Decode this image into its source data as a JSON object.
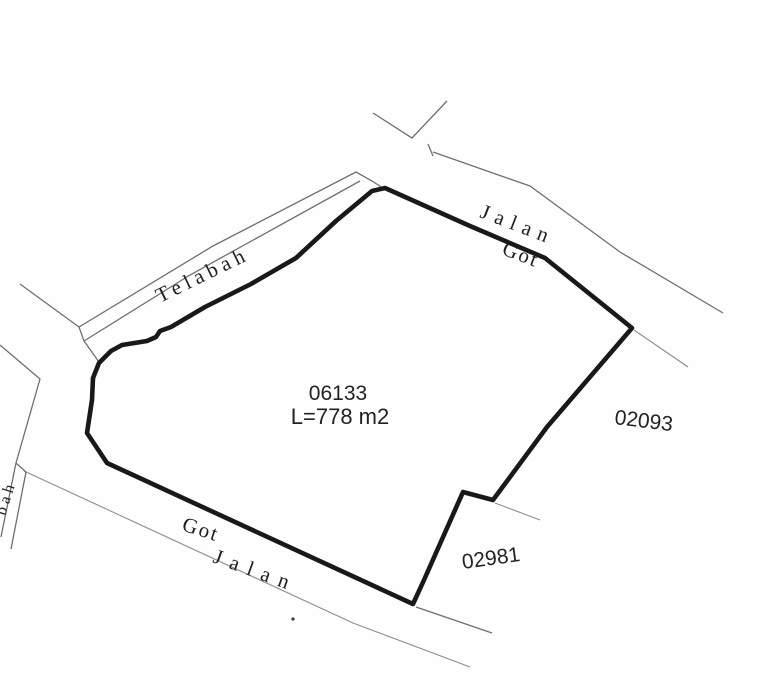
{
  "parcel": {
    "id": "06133",
    "area_label": "L=778 m2"
  },
  "neighbor_parcels": {
    "east_id": "02093",
    "southeast_id": "02981"
  },
  "roads": {
    "top_jalan": "Jalan",
    "top_got": "Got",
    "bottom_got": "Got",
    "bottom_jalan": "Jalan"
  },
  "channel": {
    "name": "Telabah",
    "left_fragment": "bah"
  },
  "colors": {
    "background": "#fefefe",
    "boundary": "#191919",
    "thin_line": "#6f6f6f",
    "label_text": "#1f1f1f"
  }
}
